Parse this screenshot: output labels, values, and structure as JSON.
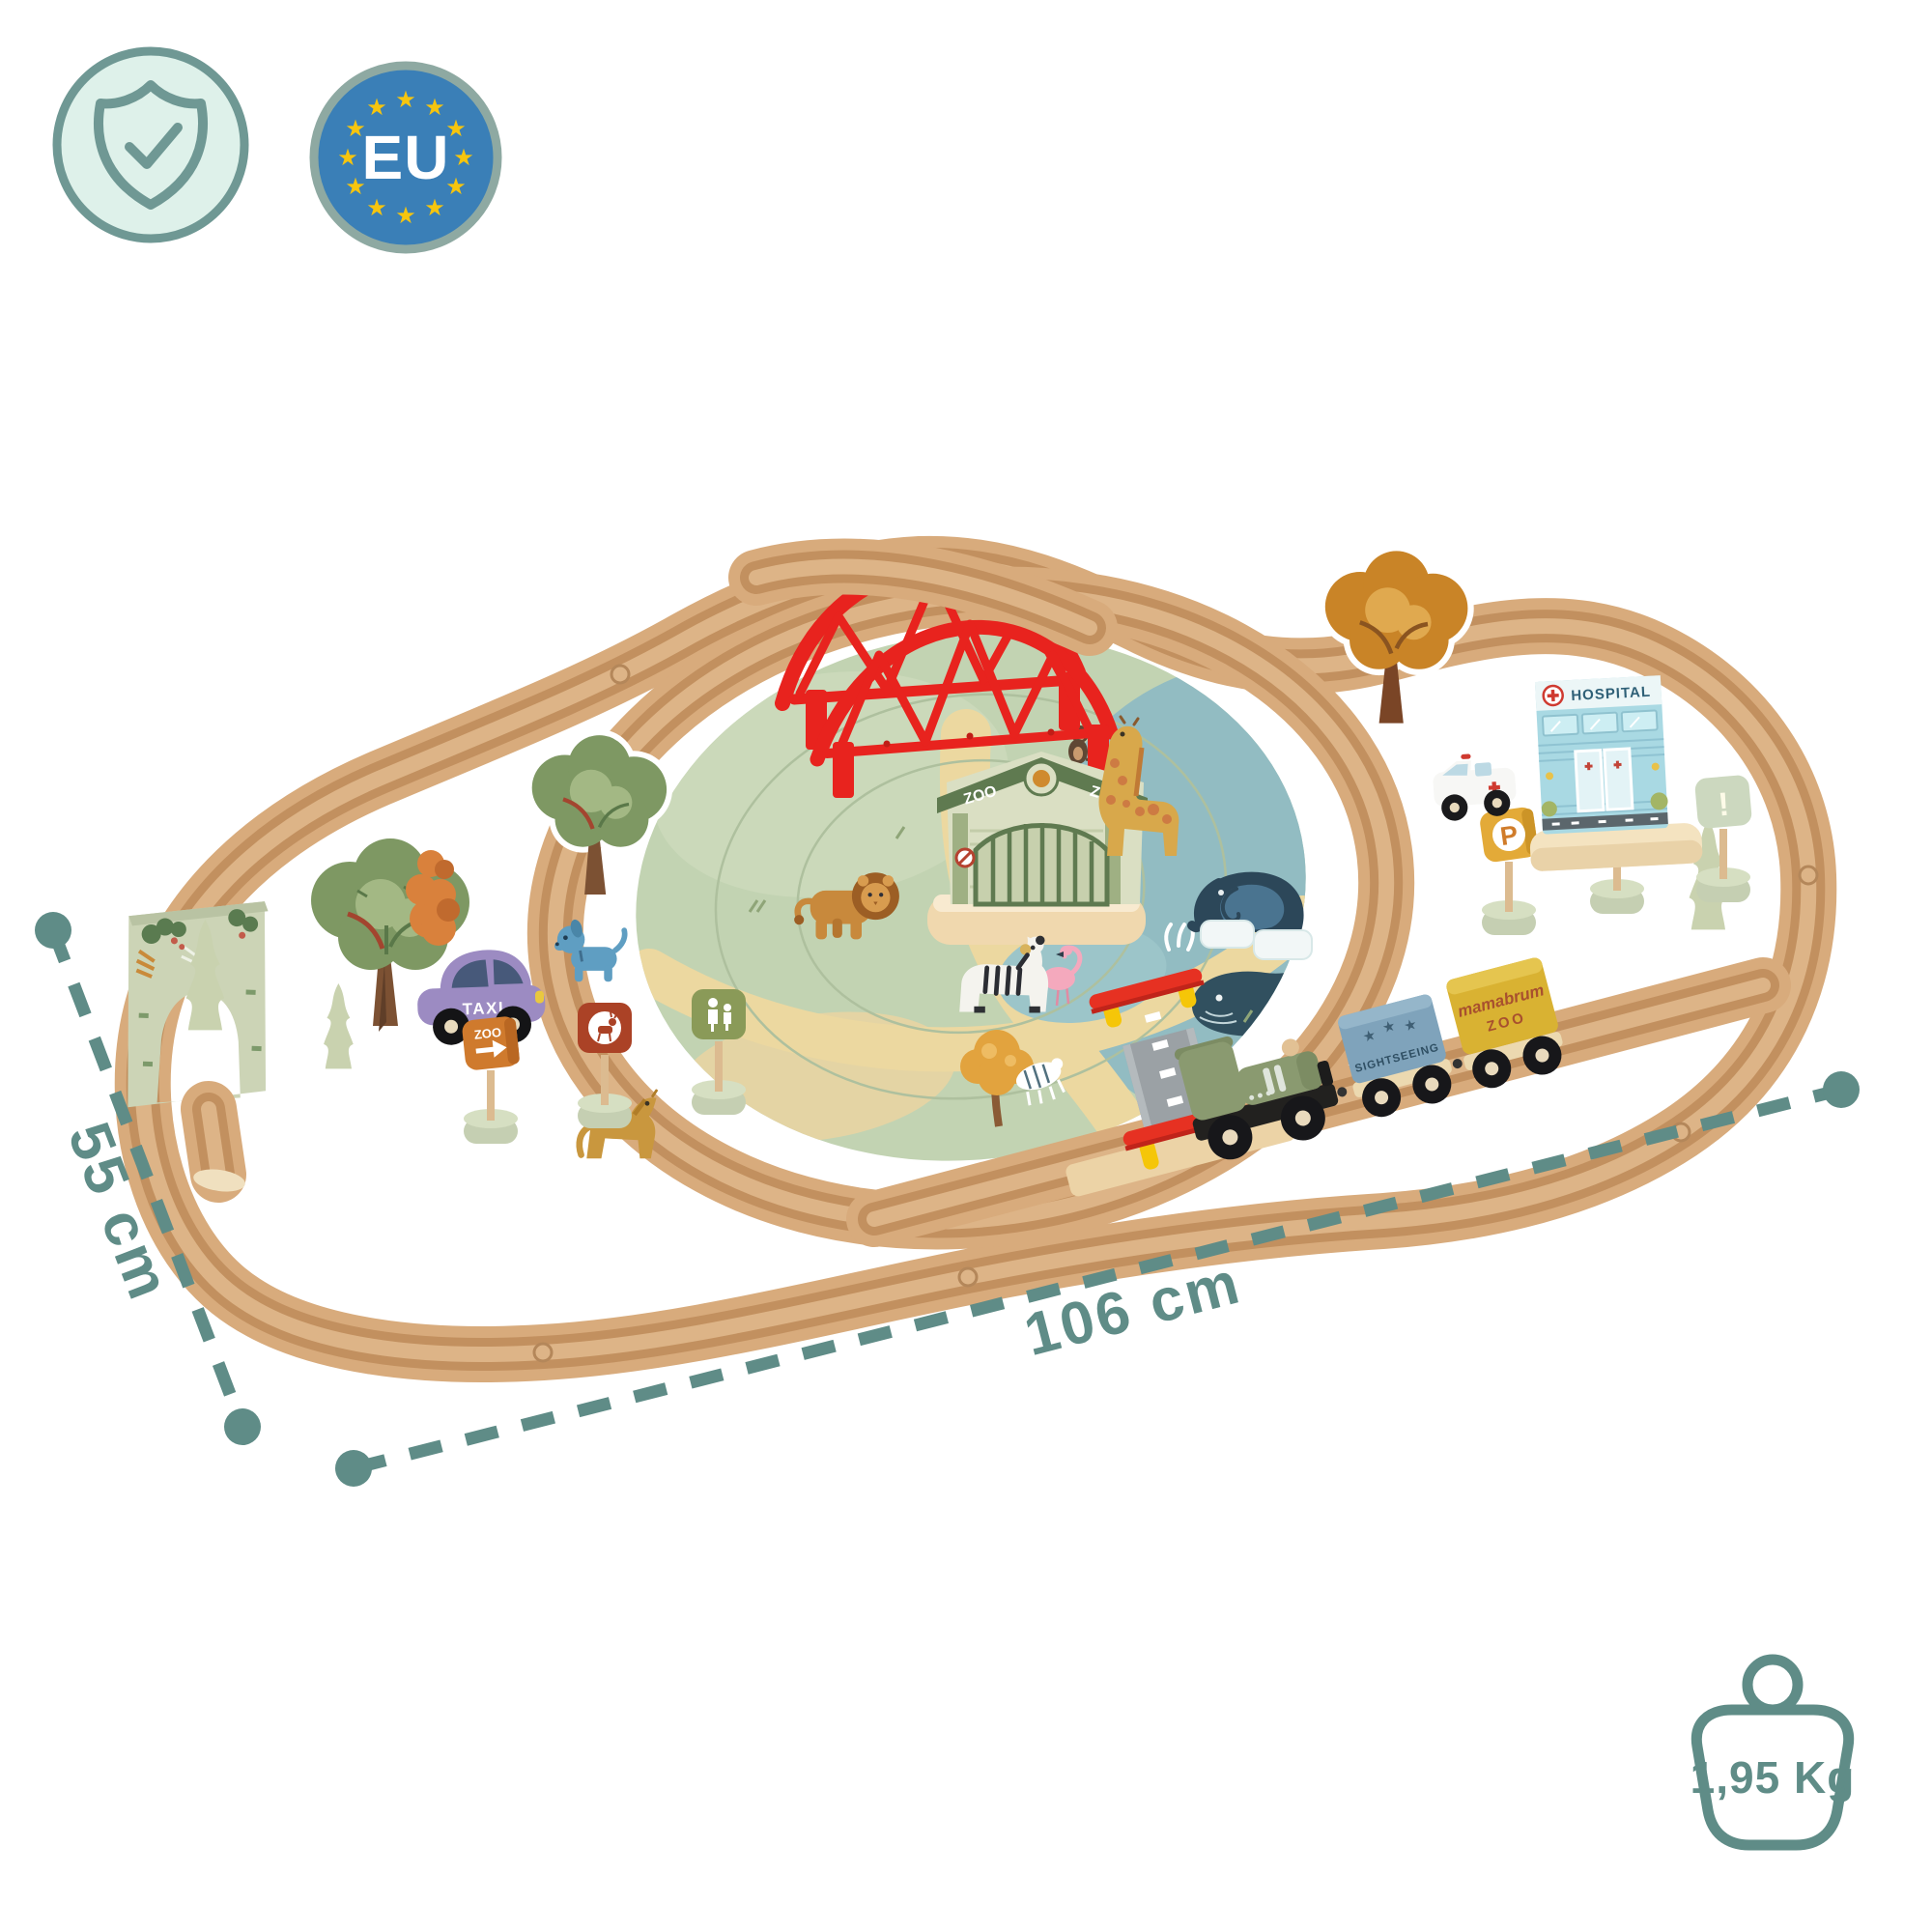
{
  "image": {
    "type": "product-infographic",
    "background": "#ffffff"
  },
  "badges": {
    "quality": {
      "icon": "shield-check-icon",
      "circle_fill": "#def1ea",
      "line_color": "#6f9894"
    },
    "eu": {
      "label": "EU",
      "circle_fill": "#3a7fb7",
      "ring_color": "#8ea9a2",
      "star_color": "#f6c50e",
      "star_glyph": "★",
      "star_count": 12
    }
  },
  "annotations": {
    "color": "#5f8c87",
    "depth_label": "55 cm",
    "width_label": "106 cm",
    "weight_label": "1,95 Kg",
    "weight_icon": "weight-kettlebell-icon"
  },
  "train": {
    "wagon_sightseeing_label": "SIGHTSEEING",
    "wagon_brand": "mamabrum",
    "wagon_brand_sub": "ZOO",
    "star_glyph": "★"
  },
  "scene": {
    "hospital_label": "HOSPITAL",
    "zoo_gate_label": "ZOO",
    "taxi_label": "TAXI",
    "sign_zoo_label": "ZOO",
    "sign_quiet_label": "BE QUIET",
    "sign_parking_label": "P",
    "sign_warning_label": "!",
    "bridge_color": "#e8231e",
    "wood_light": "#d8ab7c",
    "wood_groove": "#c2905f",
    "mat_green": "#c2d3b2",
    "mat_water": "#92bcc2",
    "mat_path": "#ecd8a0"
  }
}
